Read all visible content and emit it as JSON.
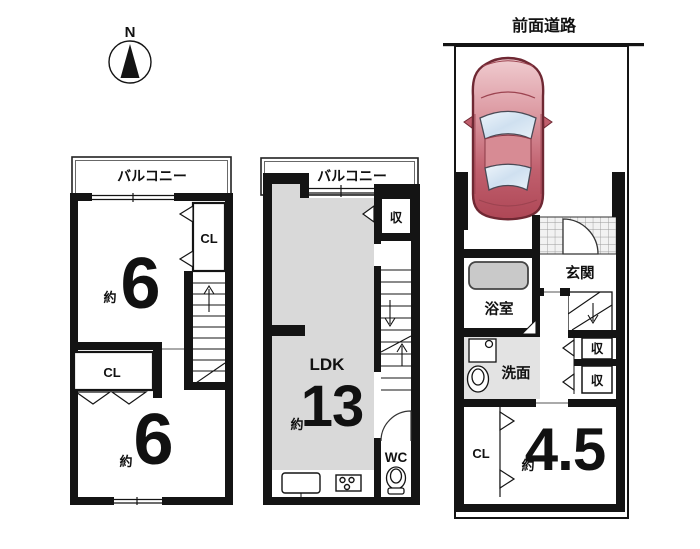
{
  "compass": {
    "north": "N"
  },
  "plan3f": {
    "balcony": "バルコニー",
    "upper_approx": "約",
    "upper_size": "6",
    "closet_upper": "CL",
    "closet_lower": "CL",
    "lower_approx": "約",
    "lower_size": "6"
  },
  "plan2f": {
    "balcony": "バルコニー",
    "storage": "収",
    "ldk_label": "LDK",
    "ldk_approx": "約",
    "ldk_size": "13",
    "wc": "WC"
  },
  "plan1f": {
    "front_road": "前面道路",
    "entrance": "玄関",
    "bathroom": "浴室",
    "washroom": "洗面",
    "storage_upper": "収",
    "storage_lower": "収",
    "closet": "CL",
    "room_approx": "約",
    "room_size": "4.5"
  },
  "colors": {
    "wall": "#141414",
    "ldk_floor": "#d9d9d9",
    "washroom_floor": "#e3e3e3",
    "bathtub": "#c9c9c9",
    "car_body_light": "#f0ccd0",
    "car_body_dark": "#ae4756",
    "car_window": "#d8e6f2"
  }
}
